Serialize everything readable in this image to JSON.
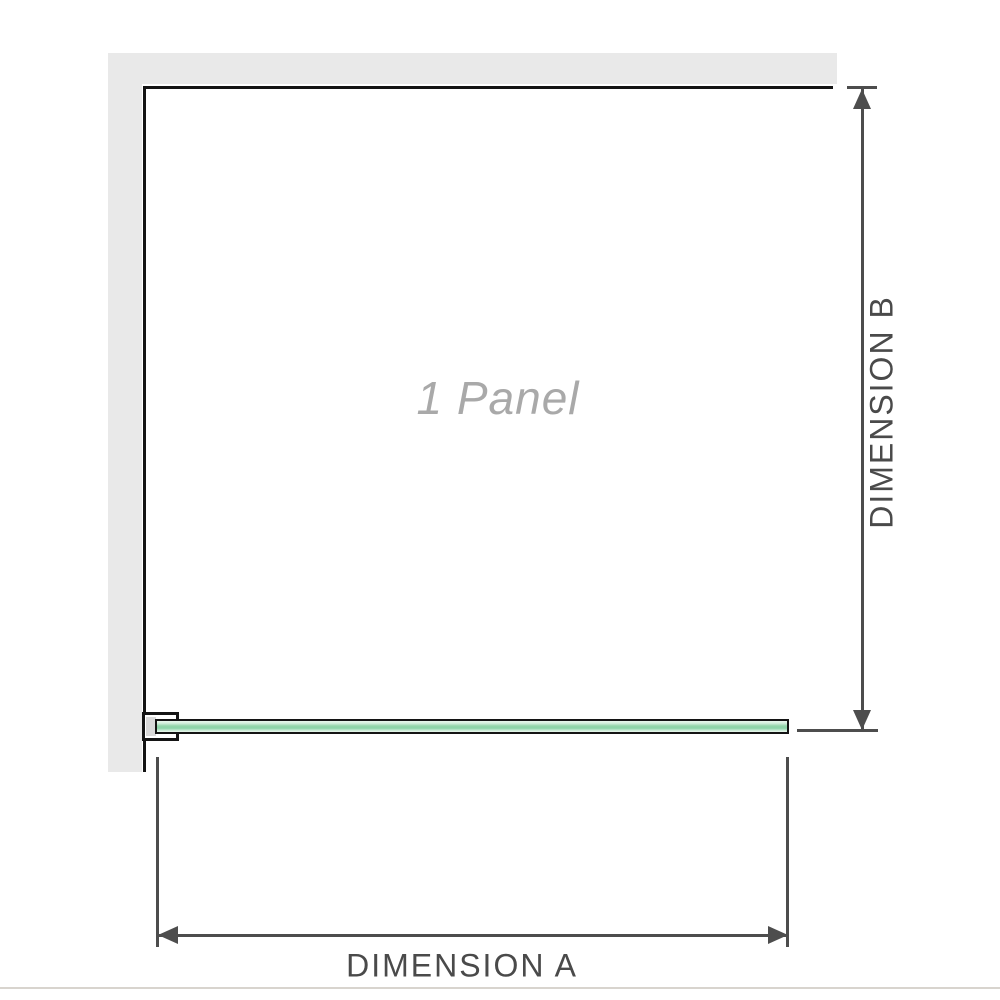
{
  "diagram": {
    "panel_label": "1 Panel",
    "dimensions": {
      "a": {
        "label": "DIMENSION A",
        "orientation": "horizontal"
      },
      "b": {
        "label": "DIMENSION B",
        "orientation": "vertical"
      }
    },
    "icons": [
      "arrow-up-icon",
      "arrow-down-icon",
      "arrow-left-icon",
      "arrow-right-icon"
    ]
  },
  "colors": {
    "wall": "#e9e9e9",
    "outline": "#141414",
    "glass_light": "#eaf7ee",
    "glass_mid": "#94d6ab",
    "bracket_pad": "#d9d9d9",
    "dimension_line": "#4d4d4d",
    "label_text": "#4a4a4a",
    "panel_label_text": "#a9a9a9",
    "baseline": "#d8d4ce"
  }
}
